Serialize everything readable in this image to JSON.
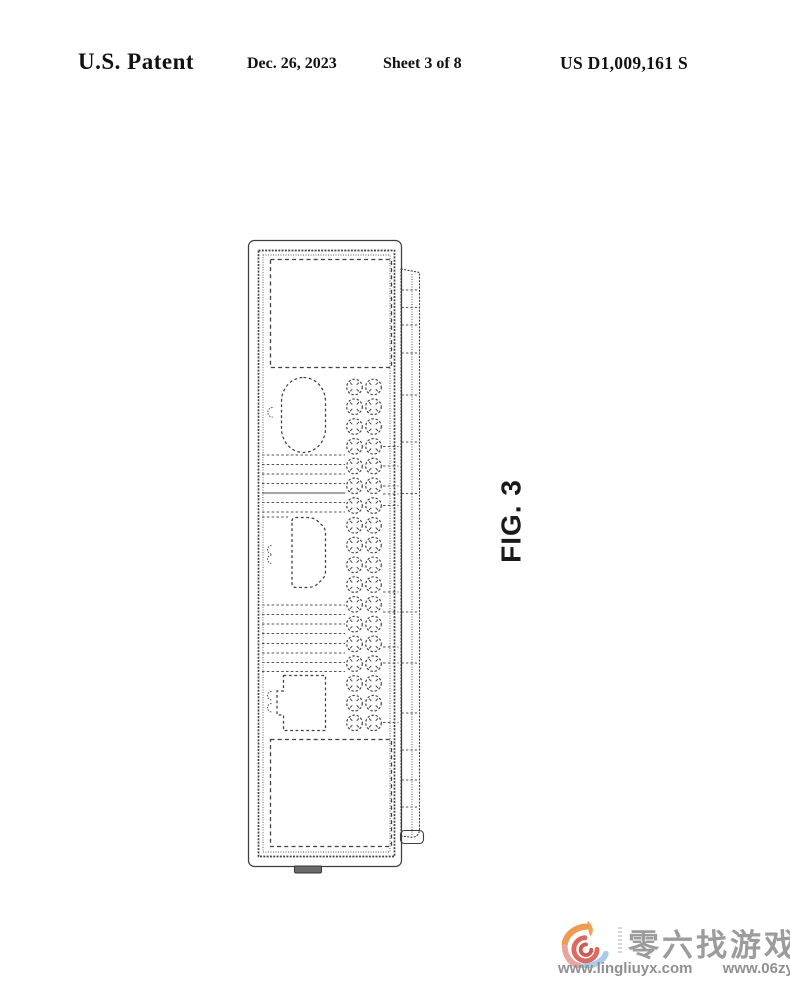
{
  "header": {
    "title": "U.S. Patent",
    "date": "Dec. 26, 2023",
    "sheet": "Sheet 3 of 8",
    "patent_number": "US D1,009,161 S"
  },
  "figure": {
    "label": "FIG. 3",
    "line_color": "#3f3f3f",
    "drawing": {
      "circle_grid": {
        "rows": 18,
        "cols": [
          354.5,
          373.5
        ],
        "y0": 387,
        "dy": 19.76,
        "r": 7.8
      },
      "band_x": [
        262,
        345
      ],
      "band1_y": [
        455,
        464.5,
        474,
        483.5,
        502.5,
        512
      ],
      "band1_solid_y": 493,
      "band1_short": {
        "y": 517,
        "x1": 262,
        "x2": 288
      },
      "band2_y": [
        605,
        614.5,
        624,
        633.5,
        643.5,
        653,
        662.5,
        671.5
      ],
      "stub_x": [
        383,
        398.5
      ],
      "stub_y": [
        446.5,
        466,
        486,
        494,
        505.5,
        592,
        612,
        647,
        663,
        722.5
      ],
      "flange_x": [
        401.5,
        419
      ],
      "flange_lines_y": [
        290,
        307.5,
        325,
        353,
        395,
        442,
        493.5,
        612,
        663,
        713,
        750,
        780,
        807
      ]
    }
  },
  "watermark": {
    "brand_text": "零六找游戏",
    "url_left": "www.lingliuyx.com",
    "url_right": "www.06zyx.com",
    "text_color": "#9a9a9a",
    "logo_colors": {
      "flame": "#f1a15b",
      "arc_orange": "#ef9a50",
      "arc_pink": "#e8a49d",
      "arc_blue": "#a9cde9",
      "spiral_red": "#d96b60",
      "spiral_core": "#cf5c52"
    }
  }
}
